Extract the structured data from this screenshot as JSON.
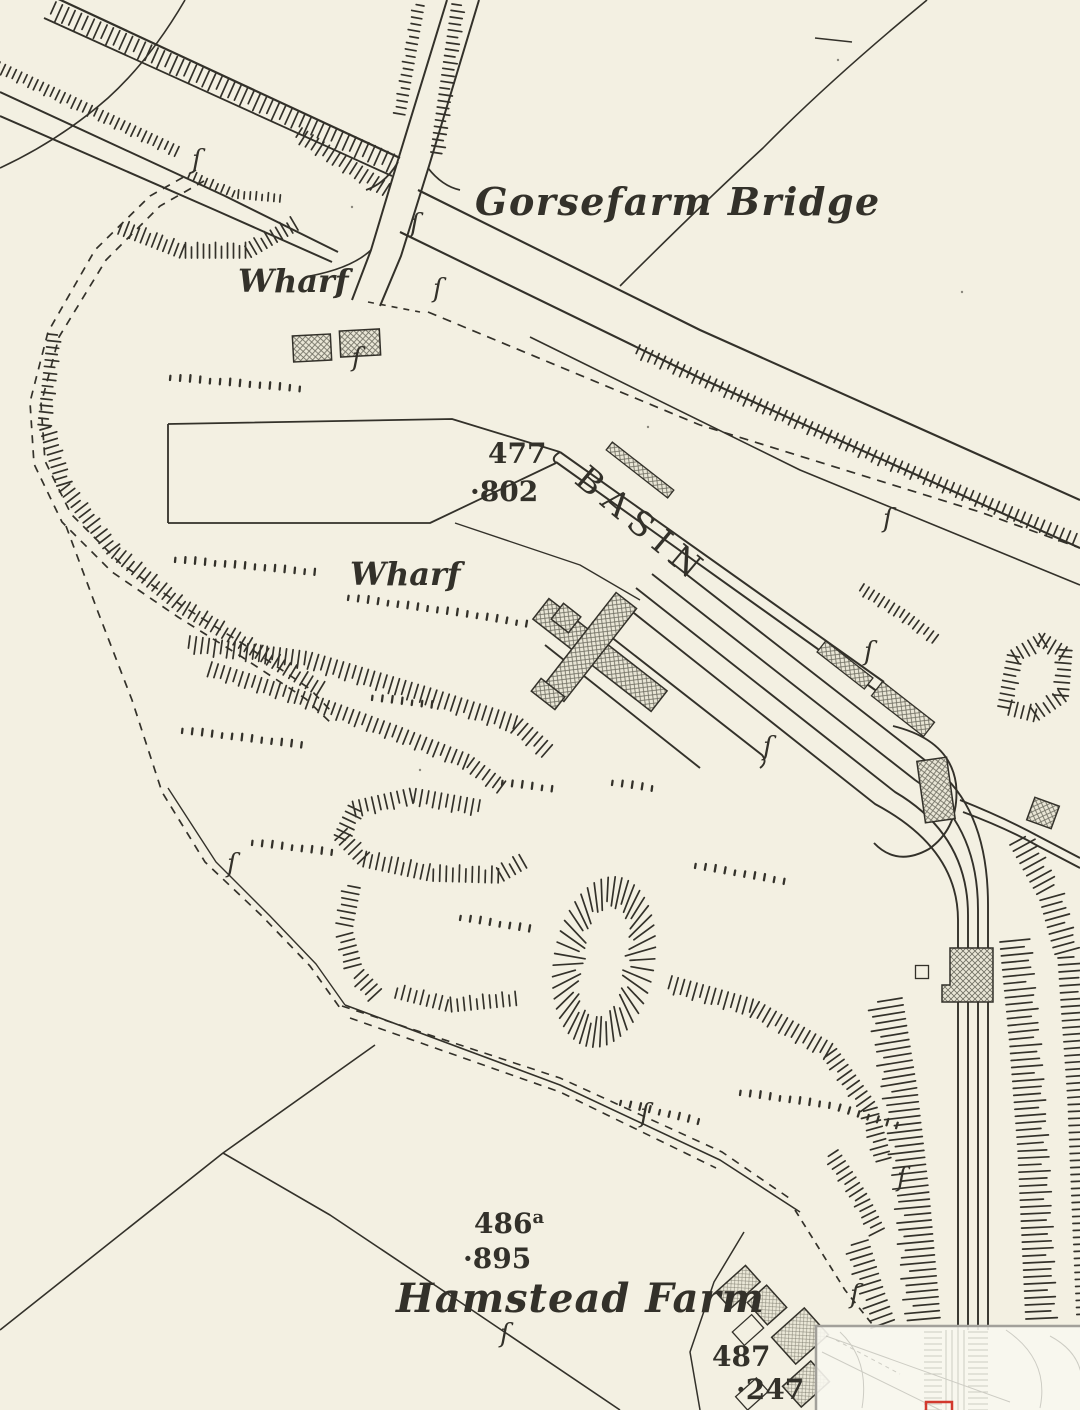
{
  "map": {
    "title": "Historic Ordnance Survey style plan of a canal basin",
    "labels": {
      "bridge": "Gorsefarm Bridge",
      "wharf_upper": "Wharf",
      "wharf_lower": "Wharf",
      "basin": "BASIN",
      "farm": "Hamstead Farm",
      "plot_477": "477",
      "level_802": "·802",
      "plot_486": "486",
      "plot_486_sup": "a",
      "level_895": "·895",
      "plot_487": "487",
      "level_247": "·247",
      "boundary_mark": "ſ"
    },
    "colors": {
      "paper": "#f3f0e2",
      "ink": "#33312a",
      "faint": "#6b6b64",
      "inset_bg": "#f8f7ef",
      "inset_border": "#a2a09a",
      "viewport_red": "#d2392e"
    },
    "inset": {
      "present": "true",
      "description": "overview minimap with red viewport rectangle"
    }
  }
}
